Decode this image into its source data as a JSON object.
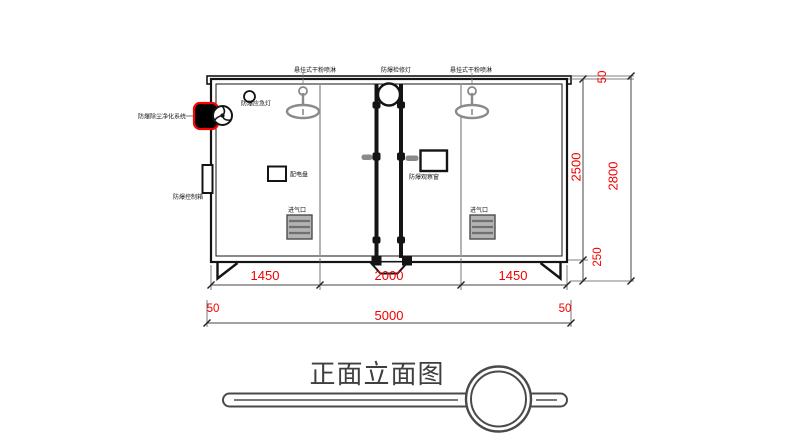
{
  "drawing_title": "正面立面图",
  "labels": {
    "spray_left": "悬挂式干粉喷淋",
    "inspection_light": "防爆检修灯",
    "spray_right": "悬挂式干粉喷淋",
    "emergency_light": "防爆应急灯",
    "purification_system": "防爆除尘净化系统",
    "control_box": "防爆控制箱",
    "power_panel": "配电盘",
    "observation_window": "防爆观察窗",
    "air_inlet_left": "进气口",
    "air_inlet_right": "进气口"
  },
  "dimensions": {
    "width_seg_left": "1450",
    "width_seg_center": "2000",
    "width_seg_right": "1450",
    "overhang_left": "50",
    "overall_width": "5000",
    "overhang_right": "50",
    "body_height": "2500",
    "roof_gap": "50",
    "overall_height": "2800",
    "base_height": "250"
  },
  "colors": {
    "dimension_red": "#f20000",
    "highlight_red": "#ff0000",
    "line_black": "#141414",
    "divider_gray": "#9b9b9b",
    "spray_gray": "#8a8a8a",
    "title_gray": "#3f3f3f"
  }
}
